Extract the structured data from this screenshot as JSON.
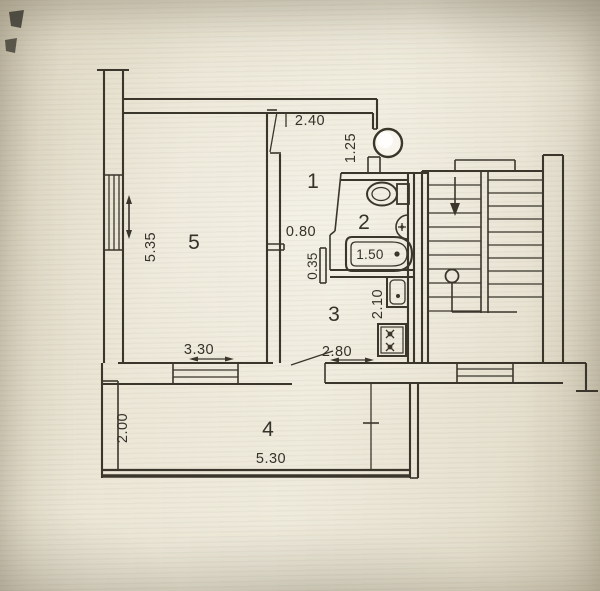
{
  "document": {
    "type": "apartment-floor-plan",
    "colors": {
      "ink": "#3a362c",
      "paper": "#e9e4d3"
    }
  },
  "rooms": [
    {
      "label": "1"
    },
    {
      "label": "2"
    },
    {
      "label": "3"
    },
    {
      "label": "4"
    },
    {
      "label": "5"
    }
  ],
  "dimensions": {
    "hall_top_width": "2.40",
    "entry_side_height": "1.25",
    "living_room_height": "5.35",
    "hall_door_width": "0.80",
    "wall_stub": "0.35",
    "bathtub_length": "1.50",
    "kitchen_depth": "2.10",
    "kitchen_width": "2.80",
    "living_room_width": "3.30",
    "balcony_depth": "2.00",
    "balcony_width": "5.30"
  },
  "icons": [
    "toilet-icon",
    "corner-sink-icon",
    "bathtub-icon",
    "kitchen-sink-icon",
    "stove-icon",
    "vent-shaft-icon",
    "stairs",
    "stair-down-arrow-icon",
    "stair-start-marker-icon",
    "window-icon",
    "door-leaf-icon"
  ]
}
